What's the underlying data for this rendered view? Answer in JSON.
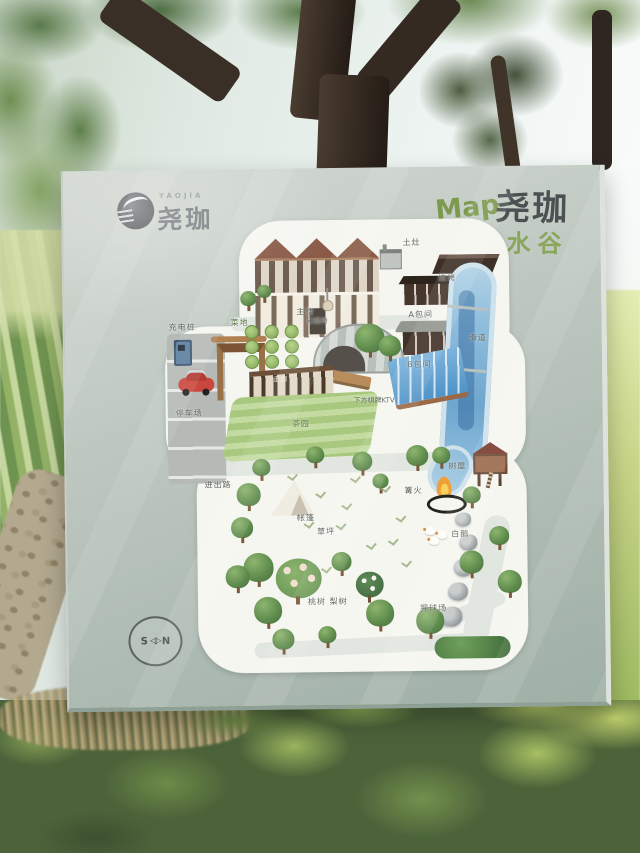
{
  "sign": {
    "logo": {
      "brand_en": "YAOJIA",
      "brand_cn": "尧珈"
    },
    "title": {
      "map": "Map",
      "of": "of",
      "brand": "尧珈",
      "site": "清水谷"
    },
    "compass": {
      "south": "S",
      "arrow": "◁▷",
      "north": "N"
    }
  },
  "map_labels": {
    "stove": "土灶",
    "bbq": "烧烤",
    "room_a": "A包间",
    "room_b": "B包间",
    "slide": "滑道",
    "main_building": "主楼",
    "swing_chair": "幻摇椅",
    "charging_pile": "充电桩",
    "parking_lot": "停车场",
    "veg_garden": "菜地",
    "corridor": "走廊",
    "pool_ktv": "下方棋牌KTV",
    "tea_garden": "茶园",
    "entry_path": "进出路",
    "tent": "帐篷",
    "lawn": "草坪",
    "bonfire": "篝火",
    "treehouse": "树屋",
    "geese": "白鹅",
    "ape_playground": "猩球场",
    "orchard": "桃树 梨树"
  },
  "colors": {
    "sign_board": "#b5c1b9",
    "map_blob": "#f6f6f1",
    "river_blue": "#7fb3d6",
    "title_green": "#7c9a4e",
    "title_orange": "#d29a4a",
    "brand_dark": "#4b5052",
    "car_red": "#c9473c",
    "flame_orange": "#ef9f38"
  }
}
